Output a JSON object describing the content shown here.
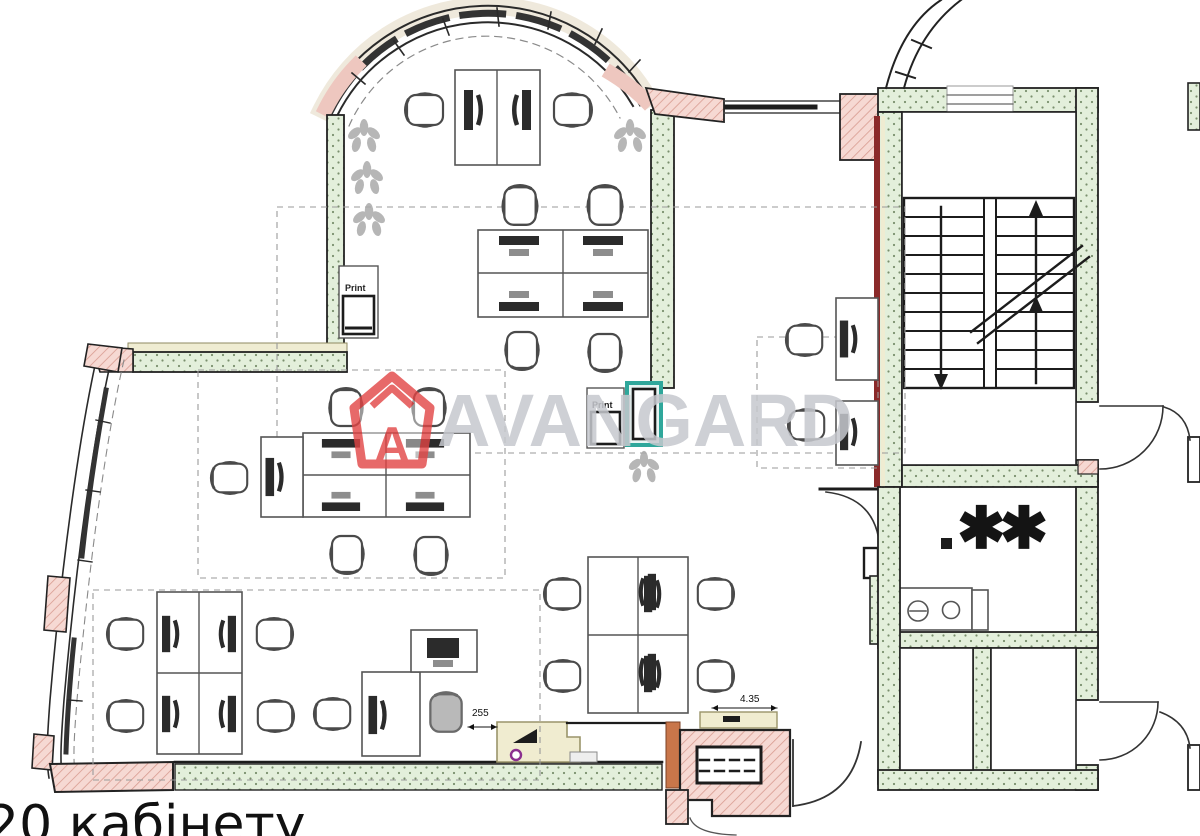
{
  "document": {
    "kind": "office floor plan drawing",
    "caption": "20 кабінету"
  },
  "watermark": {
    "brand": "AVANGARD",
    "logo_letter": "A",
    "logo_color": "#e24444",
    "text_color": "#c6c8ce"
  },
  "annotations": {
    "printer_label_1": "Print",
    "printer_label_2": "Print",
    "dimension_ramp": "255",
    "dimension_porch": "4.35",
    "room_marker_stars": "✱✱"
  },
  "palette": {
    "wall_fill_green": "#e3efdb",
    "wall_dot_green": "#7a8f6d",
    "wall_fill_pink": "#f6d9d3",
    "wall_hatch_pink": "#d89b90",
    "wall_layer_tan": "#efecd2",
    "stair_wall_red": "#8b2a2a",
    "highlight_teal": "#2fa79b",
    "marker_purple": "#8b2f8f",
    "line_dark": "#1f1f1f",
    "furniture_gray": "#555555",
    "plant_gray": "#aaaaaa",
    "porch_orange": "#c9764a"
  }
}
